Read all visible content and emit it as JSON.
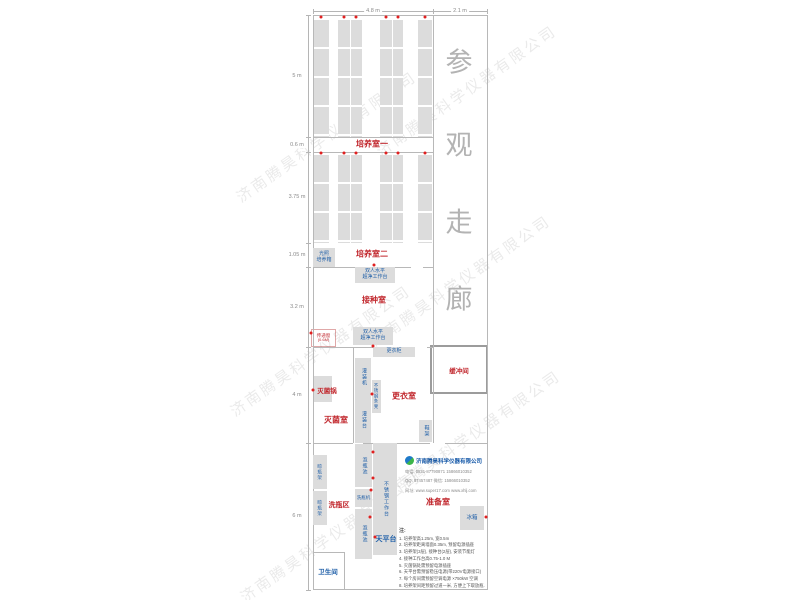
{
  "watermark_text": "济南腾昊科学仪器有限公司",
  "corridor": {
    "chars": [
      "参",
      "观",
      "走",
      "廊"
    ],
    "x": 459,
    "ys": [
      60,
      143,
      220,
      297
    ]
  },
  "pass_window": {
    "name": "传递窗",
    "size": "(0.6M)"
  },
  "buffer_room": {
    "label": "缓冲间"
  },
  "company": {
    "name": "济南腾昊科学仪器有限公司",
    "lines": [
      "电话: 0531-87790871  15866010352",
      "QQ: 87457487  微信: 15866010352",
      "网址: www.super17.com  www.xhlj.com"
    ]
  },
  "notes": {
    "heading": "注:",
    "items": [
      "1. 培养架高1.25m, 宽0.5m",
      "2. 培养架距离墙面0.35m, 预留电源插座",
      "3. 培养架(3层), 接种台(2层), 安装节能灯",
      "4. 接种工作台高0.75-1.0 M",
      "5. 灭菌锅处需预留电源插座",
      "6. 天平台需预留稳压电源(带220V电源接口)",
      "7. 每个房间需预留空调电源 ×750kW 空调",
      "8. 培养架间距预留过道一米, 方便上下取放瓶."
    ]
  },
  "dimensions": {
    "top": {
      "y": 11,
      "spans": [
        {
          "t": "4.8 m",
          "x1": 313,
          "x2": 433
        },
        {
          "t": "2.1 m",
          "x1": 433,
          "x2": 487
        }
      ]
    },
    "left": {
      "x": 308,
      "y1": 15,
      "y2": 590,
      "ticks": [
        15,
        137,
        152,
        243,
        267,
        347,
        443,
        590
      ],
      "segments": [
        {
          "t": "5 m",
          "c": 76
        },
        {
          "t": "0.6 m",
          "c": 145
        },
        {
          "t": "3.75 m",
          "c": 197
        },
        {
          "t": "1.05 m",
          "c": 255
        },
        {
          "t": "3.2 m",
          "c": 307
        },
        {
          "t": "4 m",
          "c": 395
        },
        {
          "t": "6 m",
          "c": 516
        }
      ]
    }
  },
  "room_labels": [
    {
      "t": "培养室一",
      "x": 372,
      "y": 144,
      "fs": 8
    },
    {
      "t": "培养室二",
      "x": 372,
      "y": 254,
      "fs": 8
    },
    {
      "t": "接种室",
      "x": 374,
      "y": 300,
      "fs": 8
    },
    {
      "t": "灭菌锅",
      "x": 327,
      "y": 390,
      "fs": 6.5
    },
    {
      "t": "灭菌室",
      "x": 336,
      "y": 420,
      "fs": 8
    },
    {
      "t": "更衣室",
      "x": 404,
      "y": 396,
      "fs": 8
    },
    {
      "t": "洗瓶区",
      "x": 339,
      "y": 505,
      "fs": 7
    },
    {
      "t": "准备室",
      "x": 438,
      "y": 502,
      "fs": 8
    }
  ],
  "blue_labels": [
    {
      "t": "天平台",
      "x": 386,
      "y": 539,
      "fs": 7
    },
    {
      "t": "卫生间",
      "x": 328,
      "y": 571,
      "fs": 6.5
    }
  ],
  "equipment_boxes": [
    {
      "name": "light-incubator",
      "label": "光照\n培养箱",
      "x": 313,
      "y": 248,
      "w": 22,
      "h": 19,
      "fs": 5
    },
    {
      "name": "clean-bench-1",
      "label": "双人水平\n超净工作台",
      "x": 355,
      "y": 267,
      "w": 40,
      "h": 16,
      "fs": 5
    },
    {
      "name": "clean-bench-2",
      "label": "双人水平\n超净工作台",
      "x": 353,
      "y": 327,
      "w": 40,
      "h": 18,
      "fs": 5
    },
    {
      "name": "locker",
      "label": "更衣柜",
      "x": 373,
      "y": 347,
      "w": 42,
      "h": 10,
      "fs": 5
    },
    {
      "name": "sterilizer-pot",
      "label": "",
      "x": 314,
      "y": 376,
      "w": 18,
      "h": 26,
      "fs": 5
    },
    {
      "name": "filling-machine",
      "label": "灌装机",
      "x": 355,
      "y": 358,
      "w": 16,
      "h": 38,
      "v": 1,
      "fs": 5
    },
    {
      "name": "filling-table",
      "label": "灌装台",
      "x": 355,
      "y": 396,
      "w": 16,
      "h": 47,
      "v": 1,
      "fs": 5
    },
    {
      "name": "steel-bench",
      "label": "不锈钢条凳",
      "x": 372,
      "y": 380,
      "w": 9,
      "h": 33,
      "v": 1,
      "fs": 4.3
    },
    {
      "name": "shoe-rack",
      "label": "鞋架",
      "x": 419,
      "y": 420,
      "w": 13,
      "h": 22,
      "v": 1,
      "fs": 5
    },
    {
      "name": "bottle-drying-rack-1",
      "label": "晾瓶架",
      "x": 313,
      "y": 455,
      "w": 14,
      "h": 34,
      "v": 1,
      "fs": 4.5
    },
    {
      "name": "bottle-drying-rack-2",
      "label": "晾瓶架",
      "x": 313,
      "y": 491,
      "w": 14,
      "h": 34,
      "v": 1,
      "fs": 4.5
    },
    {
      "name": "bottle-soak-pool-1",
      "label": "泡瓶池",
      "x": 355,
      "y": 444,
      "w": 17,
      "h": 43,
      "v": 1,
      "fs": 5
    },
    {
      "name": "bottle-washer",
      "label": "洗瓶机",
      "x": 355,
      "y": 489,
      "w": 17,
      "h": 18,
      "fs": 4.5
    },
    {
      "name": "bottle-soak-pool-2",
      "label": "泡瓶池",
      "x": 355,
      "y": 509,
      "w": 17,
      "h": 50,
      "v": 1,
      "fs": 5
    },
    {
      "name": "steel-worktable",
      "label": "不锈钢工作台",
      "x": 373,
      "y": 443,
      "w": 24,
      "h": 112,
      "v": 1,
      "fs": 5
    },
    {
      "name": "fridge",
      "label": "冰箱",
      "x": 460,
      "y": 506,
      "w": 24,
      "h": 24,
      "fs": 5.5
    }
  ],
  "racks": {
    "columns": [
      {
        "x": 314,
        "w": 15
      },
      {
        "x": 338,
        "w": 24
      },
      {
        "x": 380,
        "w": 23
      },
      {
        "x": 418,
        "w": 14
      }
    ],
    "rows": [
      {
        "y": 20,
        "h": 117
      },
      {
        "y": 155,
        "h": 88
      }
    ]
  },
  "walls": [
    [
      313,
      15,
      175,
      1
    ],
    [
      313,
      589,
      175,
      1
    ],
    [
      313,
      15,
      1,
      575
    ],
    [
      487,
      15,
      1,
      575
    ],
    [
      433,
      15,
      1,
      428
    ],
    [
      313,
      137,
      120,
      1
    ],
    [
      313,
      152,
      120,
      1
    ],
    [
      313,
      267,
      98,
      1
    ],
    [
      423,
      267,
      10,
      1
    ],
    [
      313,
      347,
      100,
      1
    ],
    [
      427,
      347,
      6,
      1
    ],
    [
      313,
      443,
      40,
      1
    ],
    [
      363,
      443,
      67,
      1
    ],
    [
      445,
      443,
      43,
      1
    ],
    [
      353,
      347,
      1,
      96
    ],
    [
      313,
      552,
      32,
      1
    ],
    [
      344,
      552,
      1,
      37
    ]
  ],
  "dots": [
    [
      321,
      17
    ],
    [
      344,
      17
    ],
    [
      356,
      17
    ],
    [
      386,
      17
    ],
    [
      398,
      17
    ],
    [
      425,
      17
    ],
    [
      321,
      153
    ],
    [
      344,
      153
    ],
    [
      356,
      153
    ],
    [
      386,
      153
    ],
    [
      398,
      153
    ],
    [
      425,
      153
    ],
    [
      311,
      333
    ],
    [
      374,
      265
    ],
    [
      373,
      346
    ],
    [
      313,
      390
    ],
    [
      372,
      394
    ],
    [
      373,
      452
    ],
    [
      373,
      478
    ],
    [
      371,
      490
    ],
    [
      370,
      517
    ],
    [
      375,
      537
    ],
    [
      486,
      517
    ]
  ],
  "watermarks": [
    [
      238,
      188,
      -35
    ],
    [
      378,
      142,
      -35
    ],
    [
      232,
      402,
      -35
    ],
    [
      372,
      332,
      -35
    ],
    [
      242,
      588,
      -35
    ],
    [
      382,
      487,
      -35
    ]
  ]
}
